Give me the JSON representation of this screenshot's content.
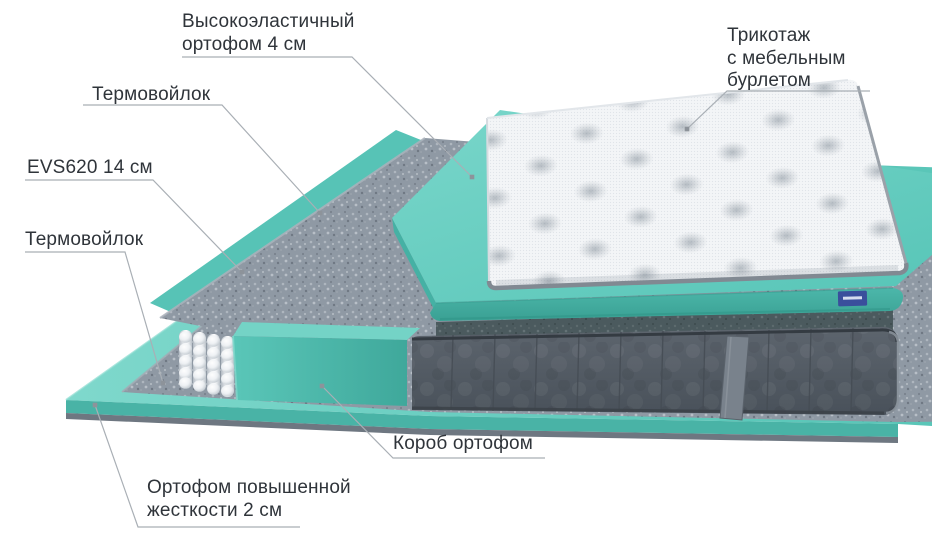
{
  "figure": {
    "kind": "mattress-layers-exploded-diagram",
    "language": "ru"
  },
  "labels": [
    {
      "id": "foam-top",
      "text": "Высокоэластичный\nортофом 4 см"
    },
    {
      "id": "knit-cover",
      "text": "Трикотаж\nс мебельным\nбурлетом"
    },
    {
      "id": "thermofelt-upper",
      "text": "Термовойлок"
    },
    {
      "id": "springs-evs620",
      "text": "EVS620 14 см"
    },
    {
      "id": "thermofelt-lower",
      "text": "Термовойлок"
    },
    {
      "id": "foam-box",
      "text": "Короб ортофом"
    },
    {
      "id": "foam-base",
      "text": "Ортофом повышенной\nжесткости 2 см"
    }
  ],
  "colors": {
    "teal": "#58c4b6",
    "teal_dark": "#3fa89b",
    "felt_gray": "#8f99a4",
    "felt_dark": "#4b5a5e",
    "spring_white": "#f1f4f6",
    "mattress_gray": "#545c65",
    "mattress_seam": "#454c54",
    "base_rim": "#6e7781",
    "cover_white": "#f3f5f7",
    "cover_piping": "#818992",
    "leader_line": "#a9afb5",
    "label_text": "#2f343a",
    "brand_tag_blue": "#3a4f9c"
  }
}
